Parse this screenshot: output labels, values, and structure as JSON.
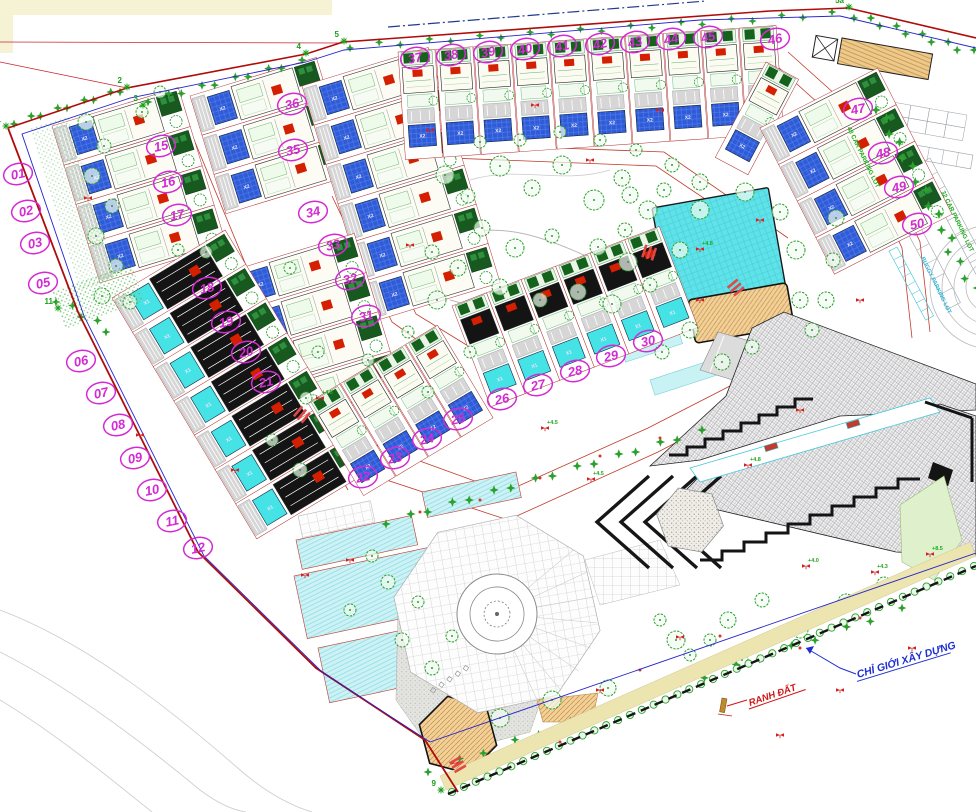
{
  "colors": {
    "lot_bubble": "#d42ad4",
    "boundary_red": "#b00b0b",
    "road_red": "#c03a2b",
    "setback_blue": "#2323cc",
    "pool_blue": "#2e5bd8",
    "pool_cyan": "#45e2e6",
    "big_pool": "#5fe3e9",
    "tree_green": "#2ca02c",
    "annotation_blue": "#1d2fd0",
    "annotation_red": "#d01414",
    "parking_text_green": "#1faa1f",
    "buggy_text_cyan": "#2bb7d8",
    "deck_tan": "#eecb92",
    "black_line": "#141414"
  },
  "labels": {
    "construction_boundary": "CHỈ GIỚI XÂY DỰNG",
    "land_boundary": "RANH ĐẤT",
    "parking_48": "48 CAR PARKING LOT",
    "parking_32": "32 CAR PARKING LOT",
    "buggy_parking": "BUGGY PARKING LOT"
  },
  "pool_labels": {
    "blue": "X2",
    "cyan": "X1"
  },
  "lots": [
    {
      "id": "01",
      "x": 18,
      "y": 174
    },
    {
      "id": "02",
      "x": 26,
      "y": 211
    },
    {
      "id": "03",
      "x": 35,
      "y": 243
    },
    {
      "id": "05",
      "x": 43,
      "y": 283
    },
    {
      "id": "06",
      "x": 81,
      "y": 361
    },
    {
      "id": "07",
      "x": 101,
      "y": 393
    },
    {
      "id": "08",
      "x": 118,
      "y": 425
    },
    {
      "id": "09",
      "x": 135,
      "y": 458
    },
    {
      "id": "10",
      "x": 152,
      "y": 490
    },
    {
      "id": "11",
      "x": 172,
      "y": 521
    },
    {
      "id": "12",
      "x": 198,
      "y": 548
    },
    {
      "id": "15",
      "x": 161,
      "y": 146
    },
    {
      "id": "16",
      "x": 168,
      "y": 182
    },
    {
      "id": "17",
      "x": 177,
      "y": 215
    },
    {
      "id": "18",
      "x": 207,
      "y": 288
    },
    {
      "id": "19",
      "x": 226,
      "y": 322
    },
    {
      "id": "20",
      "x": 246,
      "y": 352
    },
    {
      "id": "21",
      "x": 266,
      "y": 382
    },
    {
      "id": "22",
      "x": 363,
      "y": 477
    },
    {
      "id": "23",
      "x": 395,
      "y": 458
    },
    {
      "id": "24",
      "x": 427,
      "y": 439
    },
    {
      "id": "25",
      "x": 458,
      "y": 419
    },
    {
      "id": "26",
      "x": 502,
      "y": 399
    },
    {
      "id": "27",
      "x": 538,
      "y": 385
    },
    {
      "id": "28",
      "x": 575,
      "y": 371
    },
    {
      "id": "29",
      "x": 611,
      "y": 356
    },
    {
      "id": "30",
      "x": 648,
      "y": 341
    },
    {
      "id": "31",
      "x": 366,
      "y": 316
    },
    {
      "id": "32",
      "x": 350,
      "y": 279
    },
    {
      "id": "33",
      "x": 333,
      "y": 245
    },
    {
      "id": "34",
      "x": 313,
      "y": 212
    },
    {
      "id": "35",
      "x": 293,
      "y": 150
    },
    {
      "id": "36",
      "x": 292,
      "y": 104
    },
    {
      "id": "37",
      "x": 415,
      "y": 58
    },
    {
      "id": "38",
      "x": 451,
      "y": 55
    },
    {
      "id": "39",
      "x": 488,
      "y": 52
    },
    {
      "id": "40",
      "x": 525,
      "y": 49
    },
    {
      "id": "41",
      "x": 562,
      "y": 46
    },
    {
      "id": "42",
      "x": 600,
      "y": 44
    },
    {
      "id": "43",
      "x": 635,
      "y": 42
    },
    {
      "id": "44",
      "x": 671,
      "y": 39
    },
    {
      "id": "45",
      "x": 708,
      "y": 37
    },
    {
      "id": "46",
      "x": 775,
      "y": 39
    },
    {
      "id": "47",
      "x": 858,
      "y": 109
    },
    {
      "id": "48",
      "x": 883,
      "y": 153
    },
    {
      "id": "49",
      "x": 899,
      "y": 187
    },
    {
      "id": "50",
      "x": 917,
      "y": 224
    }
  ],
  "vertices": [
    {
      "id": "1",
      "x": 6,
      "y": 126
    },
    {
      "id": "2",
      "x": 127,
      "y": 87
    },
    {
      "id": "3",
      "x": 143,
      "y": 105
    },
    {
      "id": "4",
      "x": 306,
      "y": 53
    },
    {
      "id": "5",
      "x": 344,
      "y": 41
    },
    {
      "id": "5a",
      "x": 849,
      "y": 7
    },
    {
      "id": "11",
      "x": 58,
      "y": 308
    },
    {
      "id": "9",
      "x": 441,
      "y": 790
    }
  ],
  "elevations": [
    {
      "v": "+4.8",
      "x": 700,
      "y": 249
    },
    {
      "v": "+4.5",
      "x": 545,
      "y": 428
    },
    {
      "v": "+4.5",
      "x": 320,
      "y": 398
    },
    {
      "v": "+4.0",
      "x": 806,
      "y": 566
    },
    {
      "v": "+4.3",
      "x": 875,
      "y": 572
    },
    {
      "v": "+8.5",
      "x": 930,
      "y": 554
    },
    {
      "v": "+4.5",
      "x": 591,
      "y": 479
    },
    {
      "v": "+4.8",
      "x": 748,
      "y": 465
    }
  ],
  "markers": [
    [
      88,
      198
    ],
    [
      140,
      435
    ],
    [
      235,
      470
    ],
    [
      305,
      575
    ],
    [
      350,
      560
    ],
    [
      410,
      245
    ],
    [
      430,
      130
    ],
    [
      535,
      105
    ],
    [
      590,
      160
    ],
    [
      660,
      110
    ],
    [
      700,
      300
    ],
    [
      760,
      220
    ],
    [
      800,
      410
    ],
    [
      860,
      300
    ],
    [
      600,
      690
    ],
    [
      680,
      637
    ],
    [
      780,
      735
    ],
    [
      840,
      690
    ],
    [
      455,
      763
    ],
    [
      912,
      648
    ]
  ]
}
